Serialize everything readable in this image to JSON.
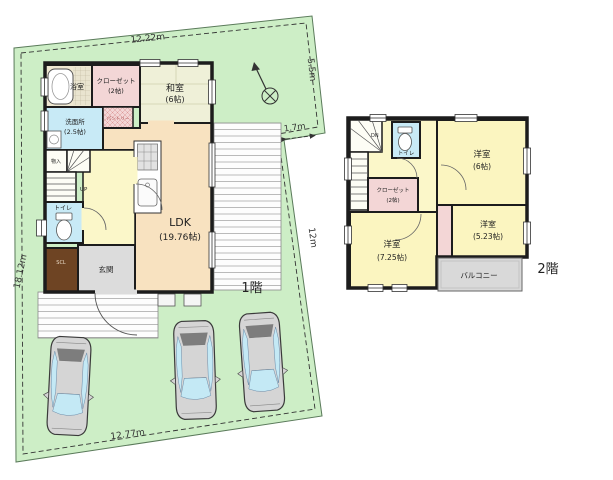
{
  "lot": {
    "dim_top": "12.22m",
    "dim_right_upper": "5.5m",
    "dim_right_jog": "1.7m",
    "dim_right_lower": "12m",
    "dim_left": "18.12m",
    "dim_bottom": "12.77m"
  },
  "floor1": {
    "label": "1階",
    "bath": "浴室",
    "closet_name": "クローゼット",
    "closet_size": "(2帖)",
    "washitsu_name": "和室",
    "washitsu_size": "(6帖)",
    "washroom_name": "洗面所",
    "washroom_size": "(2.5帖)",
    "pantry": "パントリー",
    "storage": "物入",
    "toilet": "トイレ",
    "stairs_up": "UP",
    "ldk_name": "LDK",
    "ldk_size": "(19.76帖)",
    "entrance": "玄関",
    "shoe_closet": "SCL"
  },
  "floor2": {
    "label": "2階",
    "stairs_down": "DN",
    "toilet": "トイレ",
    "closet_name": "クローゼット",
    "closet_size": "(2帖)",
    "bedroom_a_name": "洋室",
    "bedroom_a_size": "(6帖)",
    "bedroom_b_name": "洋室",
    "bedroom_b_size": "(7.25帖)",
    "bedroom_c_name": "洋室",
    "bedroom_c_size": "(5.23帖)",
    "balcony": "バルコニー"
  },
  "colors": {
    "lot_green": "#cdeec6",
    "wall": "#1c1c1c",
    "ldk_peach": "#f8e2c0",
    "tatami_cream": "#eff0d8",
    "bath_cream": "#efe8d2",
    "hall_yellow": "#fbf7c9",
    "room_yellow": "#fbf5c0",
    "closet_pink": "#f3d6d6",
    "wet_blue": "#c8eaf6",
    "entry_gray": "#dcdcdc",
    "balcony_gray": "#d9d9d9",
    "shoe_closet_brown": "#6e4423",
    "car_body": "#d5d5d5",
    "car_glass": "#c4e9f5",
    "car_rear_band": "#7d7d7d"
  }
}
